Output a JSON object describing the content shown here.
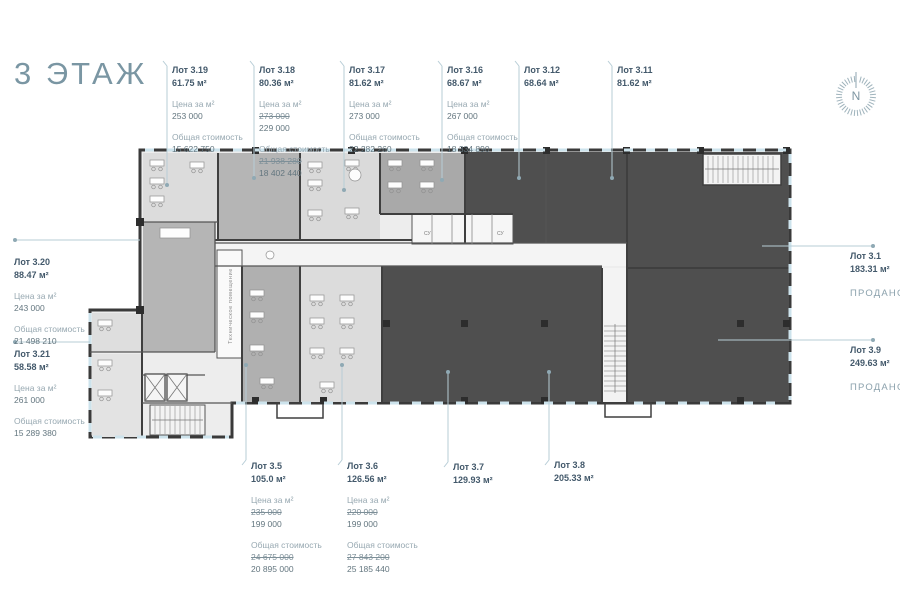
{
  "title": "3 ЭТАЖ",
  "compass": {
    "letter": "N"
  },
  "labels": {
    "price_per_m2": "Цена за м²",
    "total_cost": "Общая стоимость",
    "sold": "ПРОДАНО"
  },
  "plan": {
    "tech_room": "Техническое помещение",
    "wc": "СУ"
  },
  "colors": {
    "title": "#7a96a3",
    "leader_line": "#b7cdd6",
    "sold_room": "#4f4f4f",
    "available_room": "#dcdcdc",
    "shell_room": "#b5b5b5",
    "wall": "#3a3a3a",
    "window": "#cde3ec"
  },
  "lots": [
    {
      "name": "Лот 3.19",
      "area": "61.75 м²",
      "price": "253 000",
      "total": "15 622 750"
    },
    {
      "name": "Лот 3.18",
      "area": "80.36 м²",
      "price_old": "273 000",
      "price": "229 000",
      "total_old": "21 938 280",
      "total": "18 402 440"
    },
    {
      "name": "Лот 3.17",
      "area": "81.62 м²",
      "price": "273 000",
      "total": "22 282 260"
    },
    {
      "name": "Лот 3.16",
      "area": "68.67 м²",
      "price": "267 000",
      "total": "18 334 890"
    },
    {
      "name": "Лот 3.12",
      "area": "68.64 м²"
    },
    {
      "name": "Лот 3.11",
      "area": "81.62 м²"
    },
    {
      "name": "Лот 3.1",
      "area": "183.31 м²",
      "status": "ПРОДАНО"
    },
    {
      "name": "Лот 3.9",
      "area": "249.63 м²",
      "status": "ПРОДАНО"
    },
    {
      "name": "Лот 3.20",
      "area": "88.47 м²",
      "price": "243 000",
      "total": "21 498 210"
    },
    {
      "name": "Лот 3.21",
      "area": "58.58 м²",
      "price": "261 000",
      "total": "15 289 380"
    },
    {
      "name": "Лот 3.5",
      "area": "105.0 м²",
      "price_old": "235 000",
      "price": "199 000",
      "total_old": "24 675 000",
      "total": "20 895 000"
    },
    {
      "name": "Лот 3.6",
      "area": "126.56 м²",
      "price_old": "220 000",
      "price": "199 000",
      "total_old": "27 843 200",
      "total": "25 185 440"
    },
    {
      "name": "Лот 3.7",
      "area": "129.93 м²"
    },
    {
      "name": "Лот 3.8",
      "area": "205.33 м²"
    }
  ]
}
